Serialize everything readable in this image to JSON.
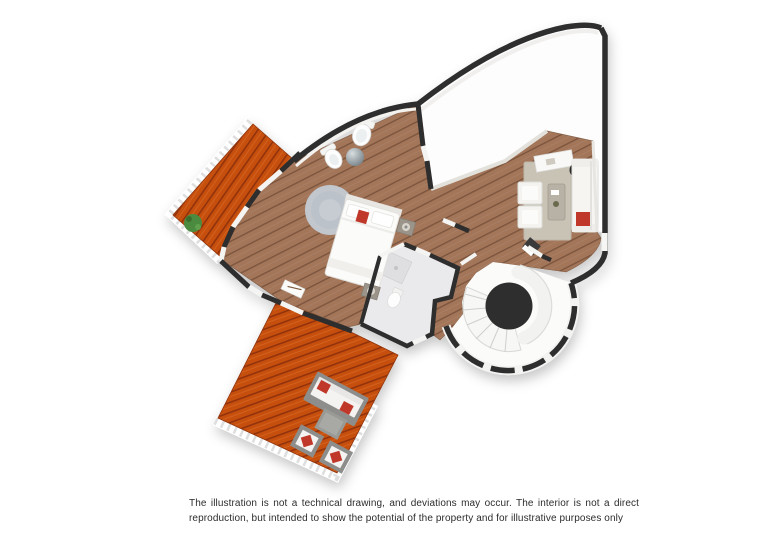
{
  "disclaimer": {
    "line1": "The illustration is not a technical drawing, and deviations may occur. The interior is not a direct",
    "line2": "reproduction, but intended to show the potential of the property and for illustrative purposes only"
  },
  "colors": {
    "wall": "#2d2d2d",
    "wood_floor": "#a3765a",
    "deck": "#c6500f",
    "bathroom_floor": "#eaeaec",
    "accent_red": "#c0392b",
    "stair_core": "#2e2e2e",
    "rug_bedroom": "#c2c7cd",
    "rug_living": "#c9c3b6"
  },
  "floor_plan": {
    "elements": [
      "upper-terrace-deck",
      "lower-terrace-deck",
      "bedroom",
      "living-area",
      "bathroom",
      "spiral-staircase",
      "bed",
      "sofa",
      "armchairs",
      "outdoor-lounge-set",
      "toilet",
      "bidet",
      "plant"
    ]
  }
}
